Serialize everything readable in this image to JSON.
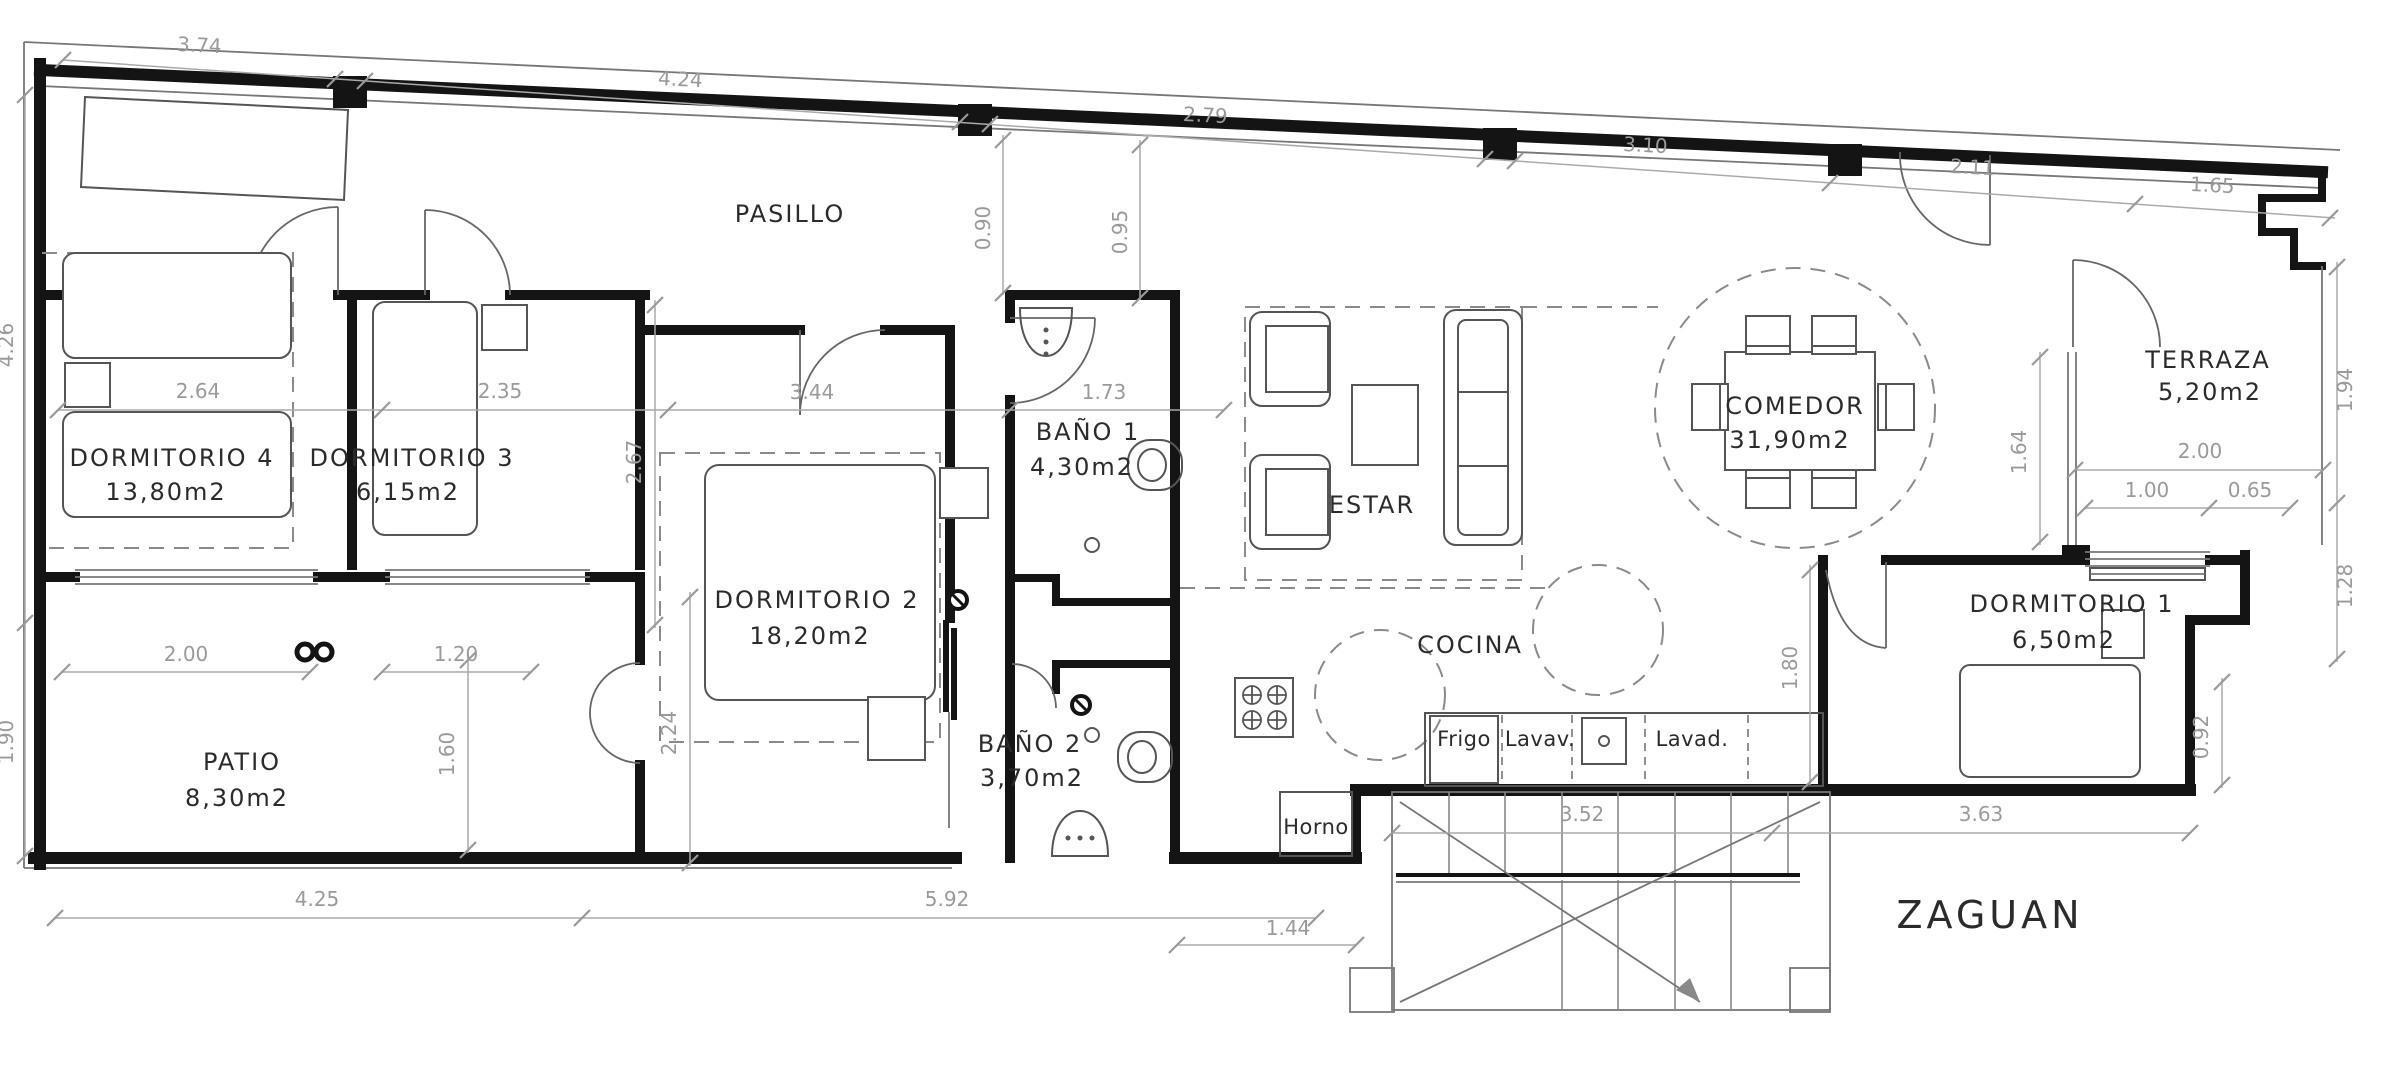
{
  "plan_title": "floor-plan",
  "rooms": {
    "pasillo": {
      "label": "PASILLO"
    },
    "dormitorio4": {
      "label": "DORMITORIO  4",
      "area": "13,80m2"
    },
    "dormitorio3": {
      "label": "DORMITORIO  3",
      "area": "6,15m2"
    },
    "dormitorio2": {
      "label": "DORMITORIO  2",
      "area": "18,20m2"
    },
    "dormitorio1": {
      "label": "DORMITORIO  1",
      "area": "6,50m2"
    },
    "bano1": {
      "label": "BAÑO  1",
      "area": "4,30m2"
    },
    "bano2": {
      "label": "BAÑO  2",
      "area": "3,70m2"
    },
    "estar": {
      "label": "ESTAR"
    },
    "comedor": {
      "label": "COMEDOR",
      "area": "31,90m2"
    },
    "cocina": {
      "label": "COCINA"
    },
    "terraza": {
      "label": "TERRAZA",
      "area": "5,20m2"
    },
    "patio": {
      "label": "PATIO",
      "area": "8,30m2"
    },
    "zaguan": {
      "label": "ZAGUAN"
    }
  },
  "appliances": {
    "frigo": "Frigo",
    "lavav": "Lavav.",
    "lavad": "Lavad.",
    "horno": "Horno"
  },
  "dims": {
    "top": [
      "3.74",
      "4.24",
      "2.79",
      "3.10",
      "2.11",
      "1.65"
    ],
    "v090": "0.90",
    "v095": "0.95",
    "left426": "4.26",
    "left190": "1.90",
    "m264": "2.64",
    "m235": "2.35",
    "m344": "3.44",
    "m173": "1.73",
    "v267": "2.67",
    "v164": "1.64",
    "v180": "1.80",
    "v160": "1.60",
    "v224": "2.24",
    "t200": "2.00",
    "t100": "1.00",
    "t065": "0.65",
    "t194": "1.94",
    "t128": "1.28",
    "t092": "0.92",
    "p200": "2.00",
    "p120": "1.20",
    "b425": "4.25",
    "b592": "5.92",
    "b144": "1.44",
    "b352": "3.52",
    "b363": "3.63"
  }
}
